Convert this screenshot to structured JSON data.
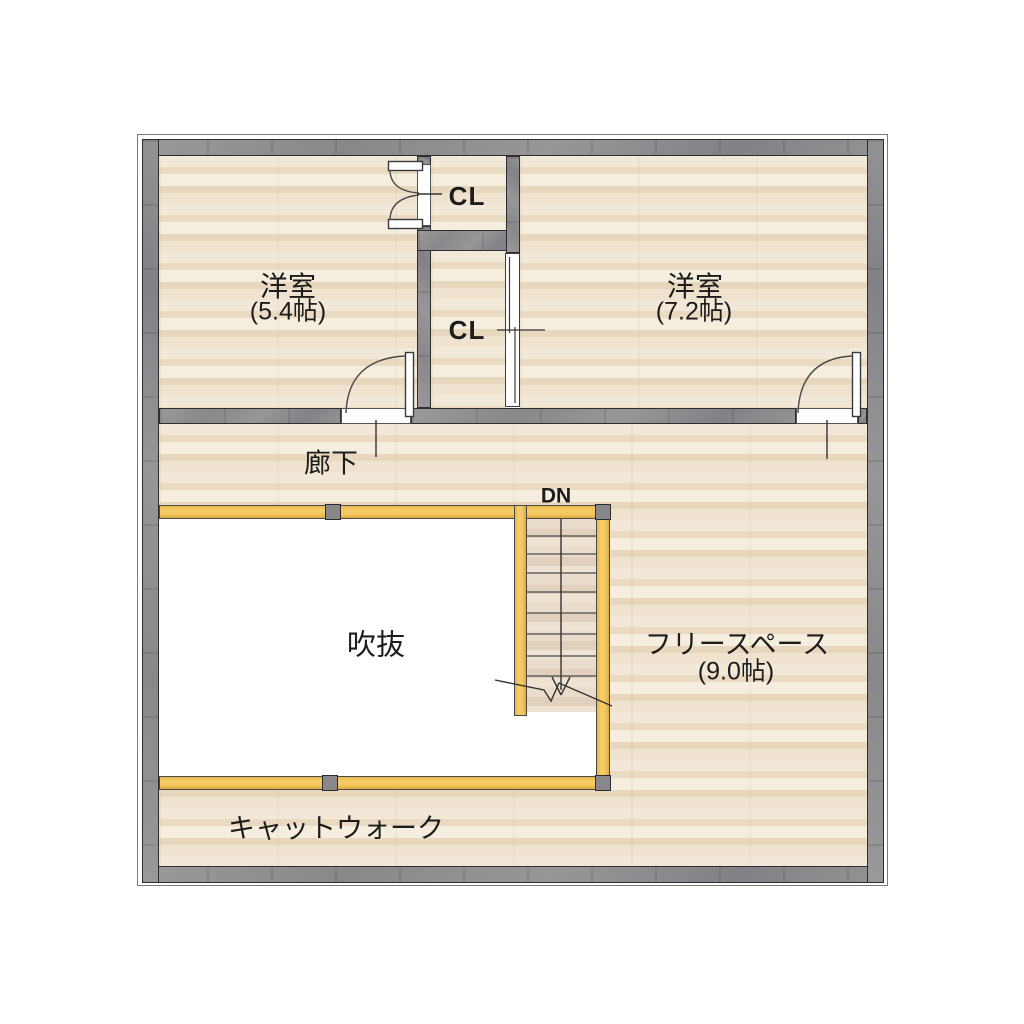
{
  "plan": {
    "type": "residential-floor-plan",
    "floor_note": "2nd floor plan with open void and stairs"
  },
  "rooms": {
    "bedroom_small": {
      "name": "洋室",
      "area": "(5.4帖)"
    },
    "bedroom_large": {
      "name": "洋室",
      "area": "(7.2帖)"
    },
    "closet_top": {
      "name": "CL"
    },
    "closet_bottom": {
      "name": "CL"
    },
    "hallway": {
      "name": "廊下"
    },
    "void": {
      "name": "吹抜"
    },
    "free_space": {
      "name": "フリースペース",
      "area": "(9.0帖)"
    },
    "catwalk": {
      "name": "キャットウォーク"
    }
  },
  "stairs": {
    "label": "DN"
  },
  "colors": {
    "wall": "#909092",
    "wall_outline": "#2e2e30",
    "floor_base": "#efe3d0",
    "floor_band_dark": "#e7d7bd",
    "railing": "#f3c65e",
    "void": "#ffffff",
    "stair_floor": "#e7dac9",
    "line": "#4a4a4c",
    "text": "#1c1c1c"
  }
}
